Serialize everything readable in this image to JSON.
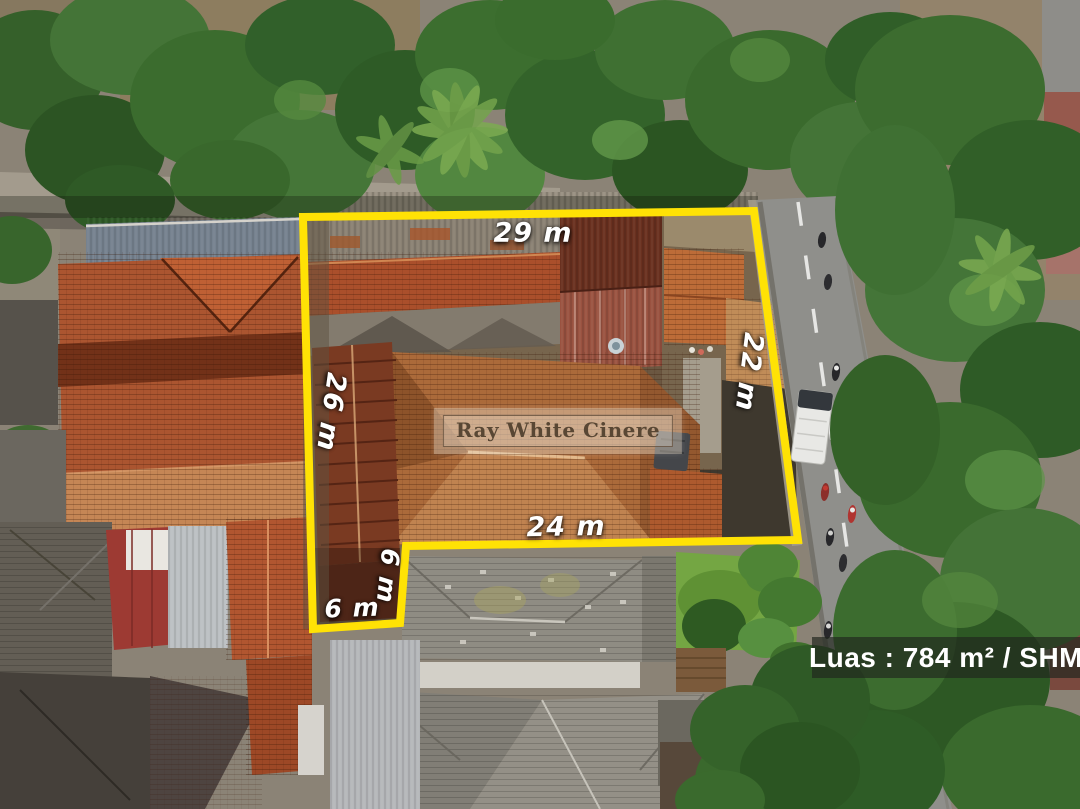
{
  "photo": {
    "type": "aerial-drone-property-photo",
    "watermark": "Ray White Cinere",
    "area_badge": "Luas : 784 m² / SHM",
    "boundary_color": "#FFE205",
    "dimensions": {
      "top": "29 m",
      "right": "22 m",
      "left": "26 m",
      "bottom": "24 m",
      "notch_side": "6 m",
      "notch_bottom": "6 m"
    }
  }
}
